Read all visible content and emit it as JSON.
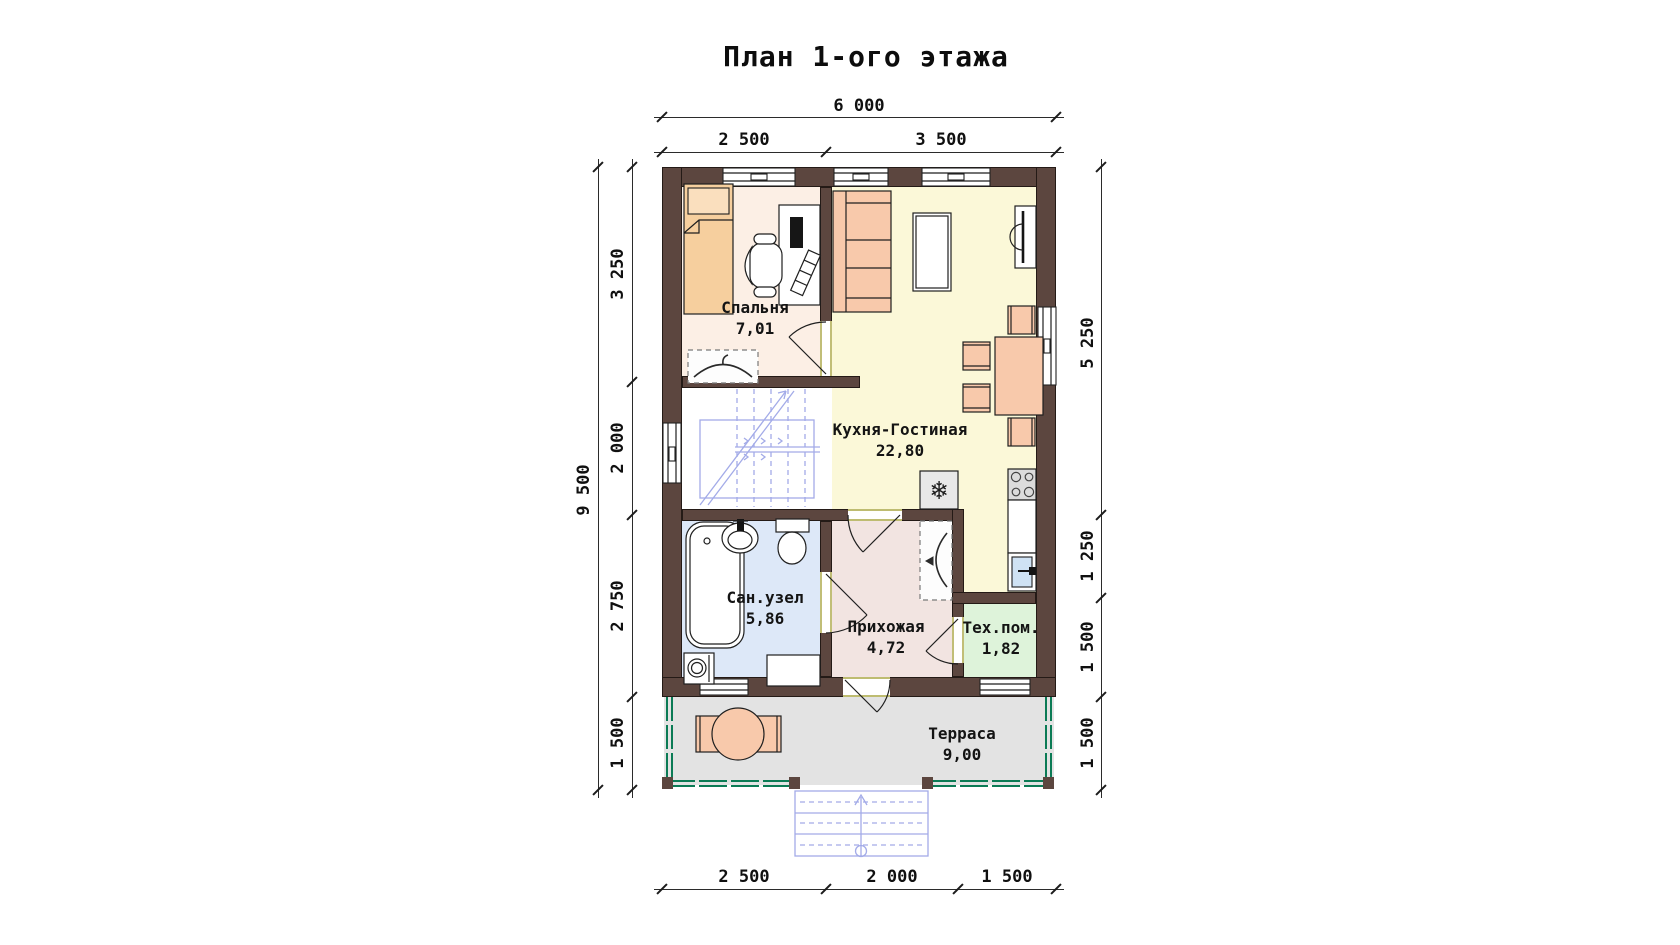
{
  "title": "План 1-ого этажа",
  "dimensions": {
    "top_total": "6 000",
    "top_segments": [
      "2 500",
      "3 500"
    ],
    "left_total": "9 500",
    "left_segments": [
      "3 250",
      "2 000",
      "2 750",
      "1 500"
    ],
    "right_segments": [
      "5 250",
      "1 250",
      "1 500",
      "1 500"
    ],
    "bottom_segments": [
      "2 500",
      "2 000",
      "1 500"
    ]
  },
  "rooms": [
    {
      "name": "Спальня",
      "area": "7,01"
    },
    {
      "name": "Кухня-Гостиная",
      "area": "22,80"
    },
    {
      "name": "Сан.узел",
      "area": "5,86"
    },
    {
      "name": "Прихожая",
      "area": "4,72"
    },
    {
      "name": "Тех.пом.",
      "area": "1,82"
    },
    {
      "name": "Терраса",
      "area": "9,00"
    }
  ],
  "icons": {
    "snowflake": "❄"
  },
  "colors": {
    "wall": "#5c463f",
    "bedroom_floor": "#fcefe5",
    "kitchen_floor": "#fbf8d8",
    "bathroom_floor": "#dde8f8",
    "hallway_floor": "#f2e4e1",
    "tech_floor": "#def3da",
    "terrace_floor": "#e3e3e3",
    "stairs_floor": "#ffffff",
    "furniture": "#f8c9ab",
    "bed": "#f6cf9e",
    "appliance_gray": "#dcdcdc",
    "sink_blue": "#cfe2f4",
    "stairs": "#a3abe8",
    "railing": "#0b7b55",
    "threshold": "#97931c"
  }
}
